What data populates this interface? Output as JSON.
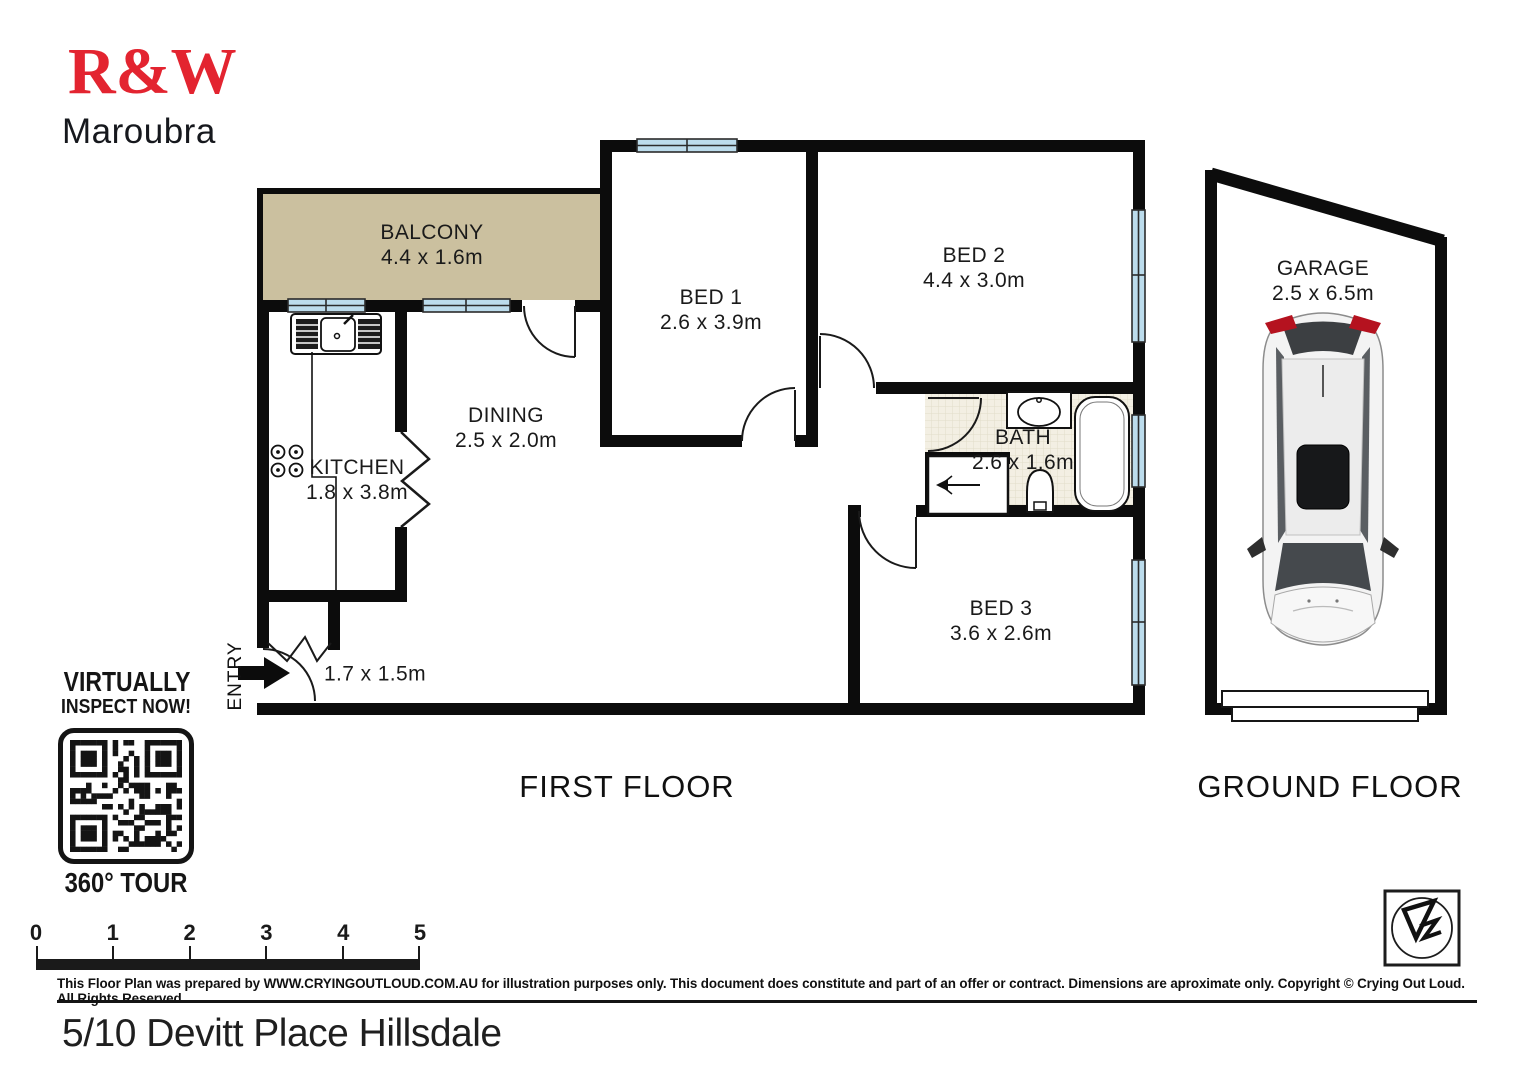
{
  "header": {
    "brand": "R&W",
    "office": "Maroubra"
  },
  "promo": {
    "line1": "VIRTUALLY",
    "line2": "INSPECT NOW!",
    "tour_label": "360° TOUR"
  },
  "rooms": [
    {
      "name": "BALCONY",
      "dims": "4.4 x 1.6m"
    },
    {
      "name": "BED 1",
      "dims": "2.6 x 3.9m"
    },
    {
      "name": "BED 2",
      "dims": "4.4 x 3.0m"
    },
    {
      "name": "DINING",
      "dims": "2.5 x 2.0m"
    },
    {
      "name": "KITCHEN",
      "dims": "1.8 x 3.8m"
    },
    {
      "name": "BATH",
      "dims": "2.6 x 1.6m"
    },
    {
      "name": "BED 3",
      "dims": "3.6 x 2.6m"
    },
    {
      "name": "GARAGE",
      "dims": "2.5 x 6.5m"
    }
  ],
  "entry": {
    "label": "ENTRY",
    "dims": "1.7 x 1.5m"
  },
  "floor_labels": {
    "first": "FIRST FLOOR",
    "ground": "GROUND FLOOR"
  },
  "scale_bar": {
    "ticks": [
      "0",
      "1",
      "2",
      "3",
      "4",
      "5"
    ]
  },
  "disclaimer": "This Floor Plan was prepared by WWW.CRYINGOUTLOUD.COM.AU for illustration purposes only. This document does constitute and part of an offer or contract. Dimensions are aproximate only. Copyright © Crying Out Loud. All Rights Reserved.",
  "address": "5/10 Devitt Place Hillsdale",
  "colors": {
    "brand_red": "#e32430",
    "wall": "#0c0c0c",
    "balcony_fill": "#cbc09f",
    "window_fill": "#bcdcec",
    "bath_floor": "#f3efe3",
    "taillight_red": "#b5121f"
  }
}
